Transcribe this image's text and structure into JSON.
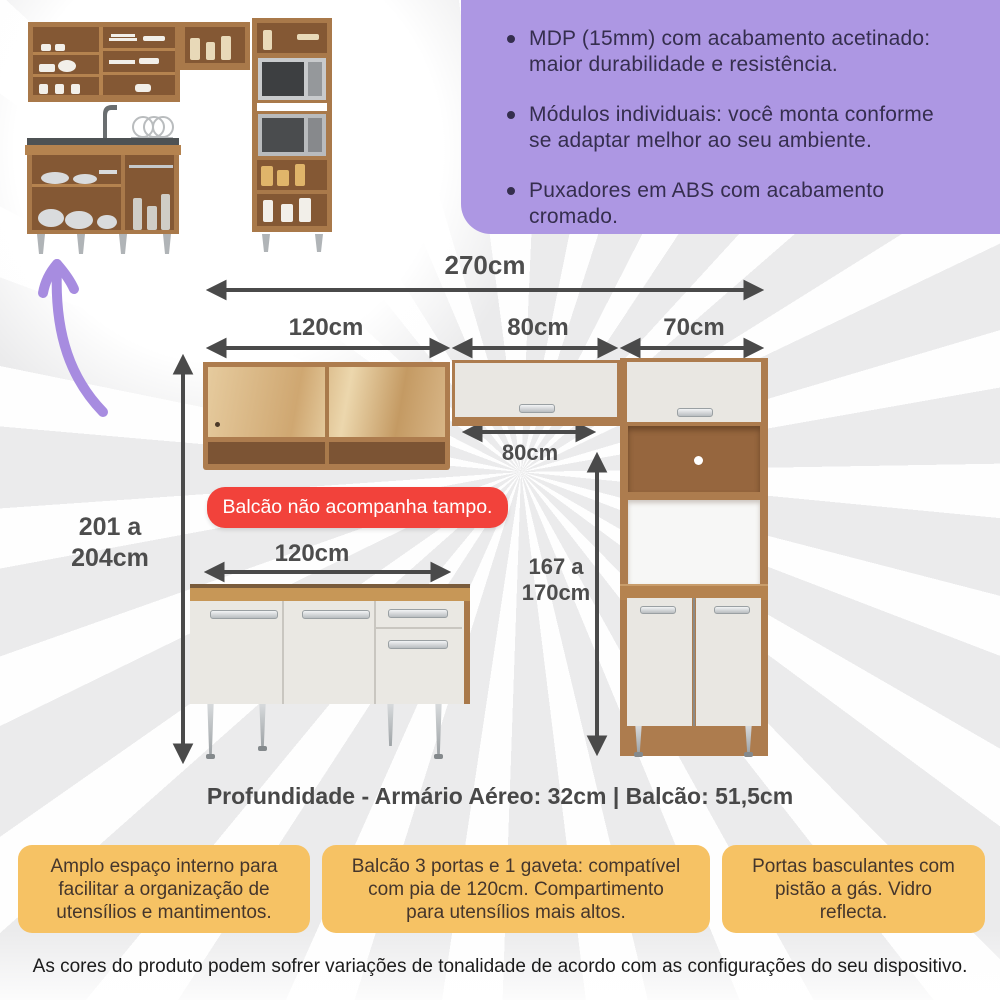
{
  "features": {
    "items": [
      {
        "lines": [
          "MDP (15mm) com acabamento acetinado:",
          "maior durabilidade e resistência."
        ]
      },
      {
        "lines": [
          "Módulos individuais: você monta conforme",
          "se adaptar melhor ao seu ambiente."
        ]
      },
      {
        "lines": [
          "Puxadores em ABS com acabamento",
          "cromado."
        ]
      }
    ]
  },
  "diagram": {
    "total_width": "270cm",
    "modules": [
      {
        "label": "120cm"
      },
      {
        "label": "80cm"
      },
      {
        "label": "70cm"
      }
    ],
    "inner_gap_width": "80cm",
    "overall_height": {
      "lines": [
        "201 a",
        "204cm"
      ]
    },
    "tower_height": {
      "lines": [
        "167 a",
        "170cm"
      ]
    },
    "counter_width": "120cm",
    "badge": "Balcão não acompanha tampo."
  },
  "depth_note": "Profundidade - Armário Aéreo: 32cm | Balcão: 51,5cm",
  "highlights": [
    {
      "lines": [
        "Amplo espaço interno para",
        "facilitar a organização de",
        "utensílios e mantimentos."
      ]
    },
    {
      "lines": [
        "Balcão 3 portas e 1 gaveta: compatível",
        "com pia de 120cm. Compartimento",
        "para utensílios mais altos."
      ]
    },
    {
      "lines": [
        "Portas basculantes com",
        "pistão a gás. Vidro",
        "reflecta."
      ]
    }
  ],
  "disclaimer": "As cores do produto podem sofrer variações de tonalidade de acordo com as configurações do seu dispositivo.",
  "colors": {
    "feature_panel": "#ad97e3",
    "badge_red": "#f2423b",
    "highlight_orange": "#f6c264",
    "dimension_gray": "#4a4a4a",
    "wood": "#ad7c4e",
    "door_white": "#e9e7e2",
    "purple_arrow": "#a78ce0"
  }
}
